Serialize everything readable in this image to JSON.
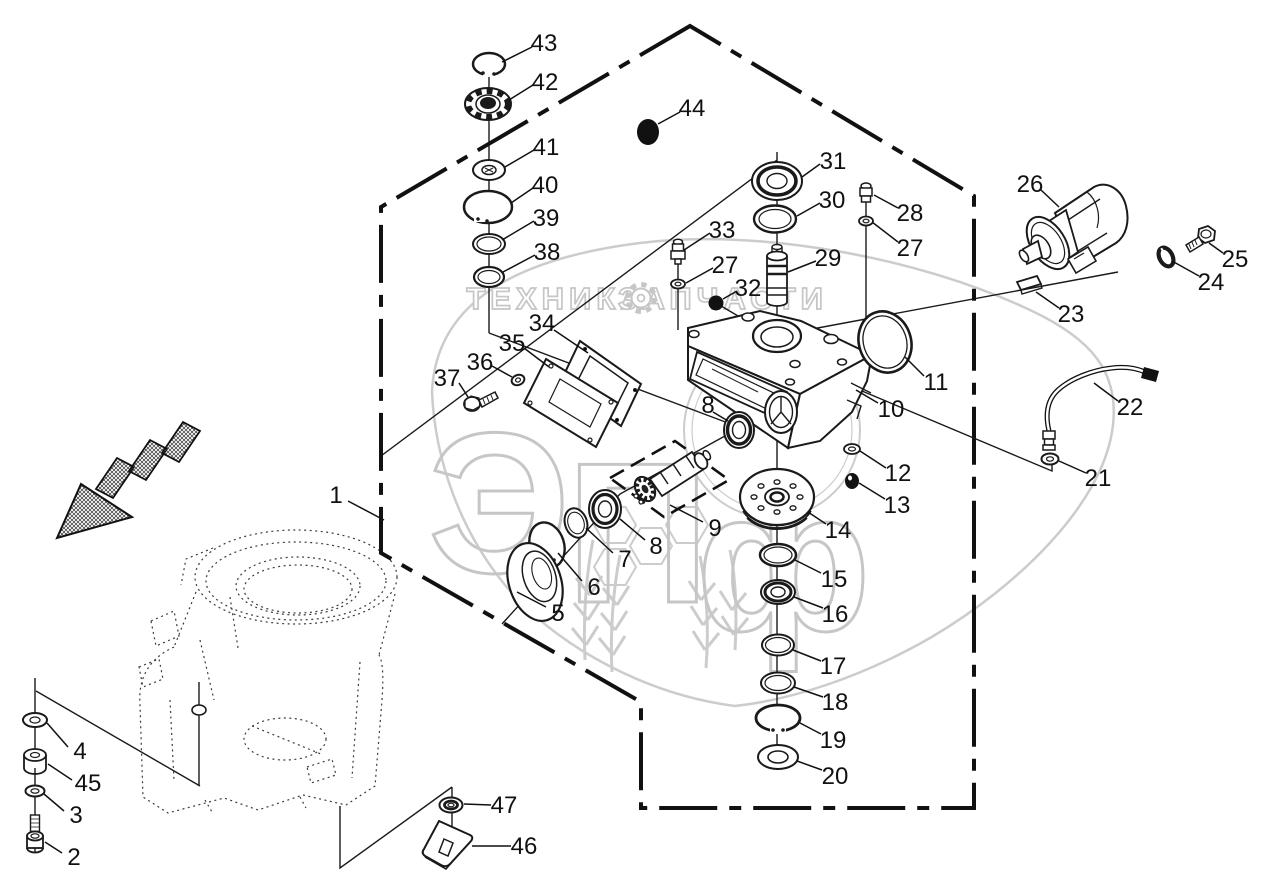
{
  "document": {
    "kind": "exploded-parts-diagram",
    "description": "Gearbox / drive housing exploded view with numbered callouts"
  },
  "watermark": {
    "word_left": "ТЕХНИКА",
    "word_right": "ЗАПЧАСТИ",
    "logo_letters": "ЭПф",
    "gear_icon": "gear",
    "color": "#c6c6c6"
  },
  "diagram": {
    "callouts": [
      {
        "n": "1",
        "label": [
          336,
          495
        ],
        "leader": [
          348,
          501,
          384,
          520
        ]
      },
      {
        "n": "2",
        "label": [
          74,
          857
        ],
        "leader": [
          62,
          853,
          45,
          842
        ]
      },
      {
        "n": "3",
        "label": [
          76,
          815
        ],
        "leader": [
          64,
          811,
          44,
          794
        ]
      },
      {
        "n": "4",
        "label": [
          80,
          751
        ],
        "leader": [
          68,
          747,
          47,
          723
        ]
      },
      {
        "n": "45",
        "label": [
          88,
          783
        ],
        "leader": [
          72,
          780,
          48,
          764
        ]
      },
      {
        "n": "5",
        "label": [
          558,
          613
        ],
        "leader": [
          546,
          607,
          517,
          592
        ]
      },
      {
        "n": "6",
        "label": [
          594,
          587
        ],
        "leader": [
          582,
          581,
          558,
          553
        ]
      },
      {
        "n": "7",
        "label": [
          625,
          559
        ],
        "leader": [
          613,
          553,
          586,
          528
        ]
      },
      {
        "n": "8",
        "label": [
          656,
          546
        ],
        "leader": [
          645,
          540,
          620,
          519
        ]
      },
      {
        "n": "8",
        "label": [
          708,
          405
        ],
        "leader": [
          713,
          412,
          728,
          421
        ]
      },
      {
        "n": "9",
        "label": [
          715,
          528
        ],
        "leader": [
          703,
          522,
          670,
          505
        ]
      },
      {
        "n": "10",
        "label": [
          891,
          409
        ],
        "leader": [
          878,
          403,
          856,
          390
        ]
      },
      {
        "n": "11",
        "label": [
          936,
          382
        ],
        "leader": [
          924,
          376,
          905,
          357
        ]
      },
      {
        "n": "12",
        "label": [
          898,
          473
        ],
        "leader": [
          886,
          468,
          860,
          451
        ]
      },
      {
        "n": "13",
        "label": [
          897,
          505
        ],
        "leader": [
          885,
          499,
          859,
          483
        ]
      },
      {
        "n": "14",
        "label": [
          838,
          530
        ],
        "leader": [
          826,
          524,
          808,
          512
        ]
      },
      {
        "n": "15",
        "label": [
          834,
          579
        ],
        "leader": [
          821,
          573,
          795,
          560
        ]
      },
      {
        "n": "16",
        "label": [
          835,
          614
        ],
        "leader": [
          823,
          608,
          794,
          597
        ]
      },
      {
        "n": "17",
        "label": [
          833,
          666
        ],
        "leader": [
          821,
          661,
          793,
          650
        ]
      },
      {
        "n": "18",
        "label": [
          835,
          702
        ],
        "leader": [
          823,
          697,
          794,
          687
        ]
      },
      {
        "n": "19",
        "label": [
          833,
          740
        ],
        "leader": [
          821,
          734,
          800,
          723
        ]
      },
      {
        "n": "20",
        "label": [
          835,
          776
        ],
        "leader": [
          822,
          770,
          797,
          761
        ]
      },
      {
        "n": "21",
        "label": [
          1098,
          478
        ],
        "leader": [
          1086,
          473,
          1059,
          461
        ]
      },
      {
        "n": "22",
        "label": [
          1130,
          407
        ],
        "leader": [
          1118,
          401,
          1094,
          383
        ]
      },
      {
        "n": "23",
        "label": [
          1071,
          314
        ],
        "leader": [
          1059,
          308,
          1036,
          292
        ]
      },
      {
        "n": "24",
        "label": [
          1211,
          282
        ],
        "leader": [
          1199,
          276,
          1172,
          261
        ]
      },
      {
        "n": "25",
        "label": [
          1235,
          259
        ],
        "leader": [
          1223,
          253,
          1209,
          243
        ]
      },
      {
        "n": "26",
        "label": [
          1030,
          184
        ],
        "leader": [
          1041,
          190,
          1059,
          207
        ]
      },
      {
        "n": "27",
        "label": [
          725,
          265
        ],
        "leader": [
          713,
          268,
          686,
          283
        ]
      },
      {
        "n": "27",
        "label": [
          910,
          248
        ],
        "leader": [
          898,
          242,
          872,
          222
        ]
      },
      {
        "n": "28",
        "label": [
          910,
          213
        ],
        "leader": [
          898,
          208,
          874,
          195
        ]
      },
      {
        "n": "29",
        "label": [
          828,
          258
        ],
        "leader": [
          816,
          261,
          788,
          272
        ]
      },
      {
        "n": "30",
        "label": [
          832,
          200
        ],
        "leader": [
          820,
          203,
          797,
          216
        ]
      },
      {
        "n": "31",
        "label": [
          833,
          161
        ],
        "leader": [
          820,
          164,
          802,
          177
        ]
      },
      {
        "n": "32",
        "label": [
          748,
          288
        ],
        "leader": [
          737,
          291,
          723,
          299
        ]
      },
      {
        "n": "33",
        "label": [
          722,
          230
        ],
        "leader": [
          710,
          233,
          684,
          250
        ]
      },
      {
        "n": "34",
        "label": [
          542,
          323
        ],
        "leader": [
          554,
          330,
          588,
          353
        ]
      },
      {
        "n": "35",
        "label": [
          512,
          343
        ],
        "leader": [
          524,
          348,
          549,
          367
        ]
      },
      {
        "n": "36",
        "label": [
          480,
          362
        ],
        "leader": [
          492,
          366,
          512,
          377
        ]
      },
      {
        "n": "37",
        "label": [
          447,
          378
        ],
        "leader": [
          459,
          383,
          468,
          397
        ]
      },
      {
        "n": "38",
        "label": [
          547,
          252
        ],
        "leader": [
          535,
          255,
          503,
          272
        ]
      },
      {
        "n": "39",
        "label": [
          546,
          218
        ],
        "leader": [
          534,
          221,
          502,
          240
        ]
      },
      {
        "n": "40",
        "label": [
          545,
          185
        ],
        "leader": [
          533,
          188,
          511,
          203
        ]
      },
      {
        "n": "41",
        "label": [
          546,
          147
        ],
        "leader": [
          534,
          150,
          505,
          167
        ]
      },
      {
        "n": "42",
        "label": [
          545,
          82
        ],
        "leader": [
          533,
          85,
          509,
          100
        ]
      },
      {
        "n": "43",
        "label": [
          544,
          43
        ],
        "leader": [
          532,
          47,
          502,
          62
        ]
      },
      {
        "n": "44",
        "label": [
          692,
          108
        ],
        "leader": [
          680,
          112,
          658,
          124
        ]
      },
      {
        "n": "46",
        "label": [
          524,
          846
        ],
        "leader": [
          511,
          846,
          472,
          846
        ]
      },
      {
        "n": "47",
        "label": [
          504,
          805
        ],
        "leader": [
          491,
          805,
          464,
          804
        ]
      }
    ]
  }
}
